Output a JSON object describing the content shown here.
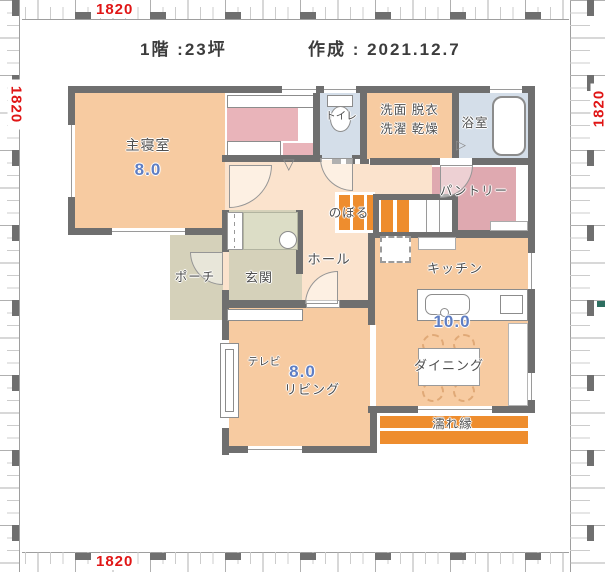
{
  "title": {
    "floor": "1階 :23坪",
    "created": "作成 : 2021.12.7"
  },
  "ruler": {
    "top": "1820",
    "bottom": "1820",
    "left": "1820",
    "right": "1820",
    "label_color": "#e01616"
  },
  "colors": {
    "wall": "#6f6f6f",
    "room_peach": "#f7cba1",
    "hall_light": "#fbe3cd",
    "water_blue": "#d4dee9",
    "closet_pink": "#e9b4ba",
    "pantry_pink": "#dfa9b0",
    "earth_beige": "#d5d1ba",
    "cabinet_green": "#dcddc6",
    "stair_orange": "#ee8d2e",
    "size_blue": "#5f7ec3"
  },
  "rooms": {
    "bedroom": {
      "label": "主寝室",
      "size": "8.0"
    },
    "toilet": {
      "label": "トイレ"
    },
    "laundry": {
      "label_line1": "洗面 脱衣",
      "label_line2": "洗濯 乾燥"
    },
    "bath": {
      "label": "浴室"
    },
    "pantry": {
      "label": "パントリー"
    },
    "stairs": {
      "label": "のぼる"
    },
    "hall": {
      "label": "ホール"
    },
    "entrance": {
      "label": "玄関"
    },
    "porch": {
      "label": "ポーチ"
    },
    "kitchen": {
      "label": "キッチン"
    },
    "ldk": {
      "size": "10.0"
    },
    "dining": {
      "label": "ダイニング"
    },
    "living": {
      "label": "リビング",
      "size": "8.0"
    },
    "tv": {
      "label": "テレビ"
    },
    "veranda": {
      "label": "濡れ縁"
    }
  },
  "icons": {
    "closet_door": "▽",
    "bath_door": "▷"
  }
}
